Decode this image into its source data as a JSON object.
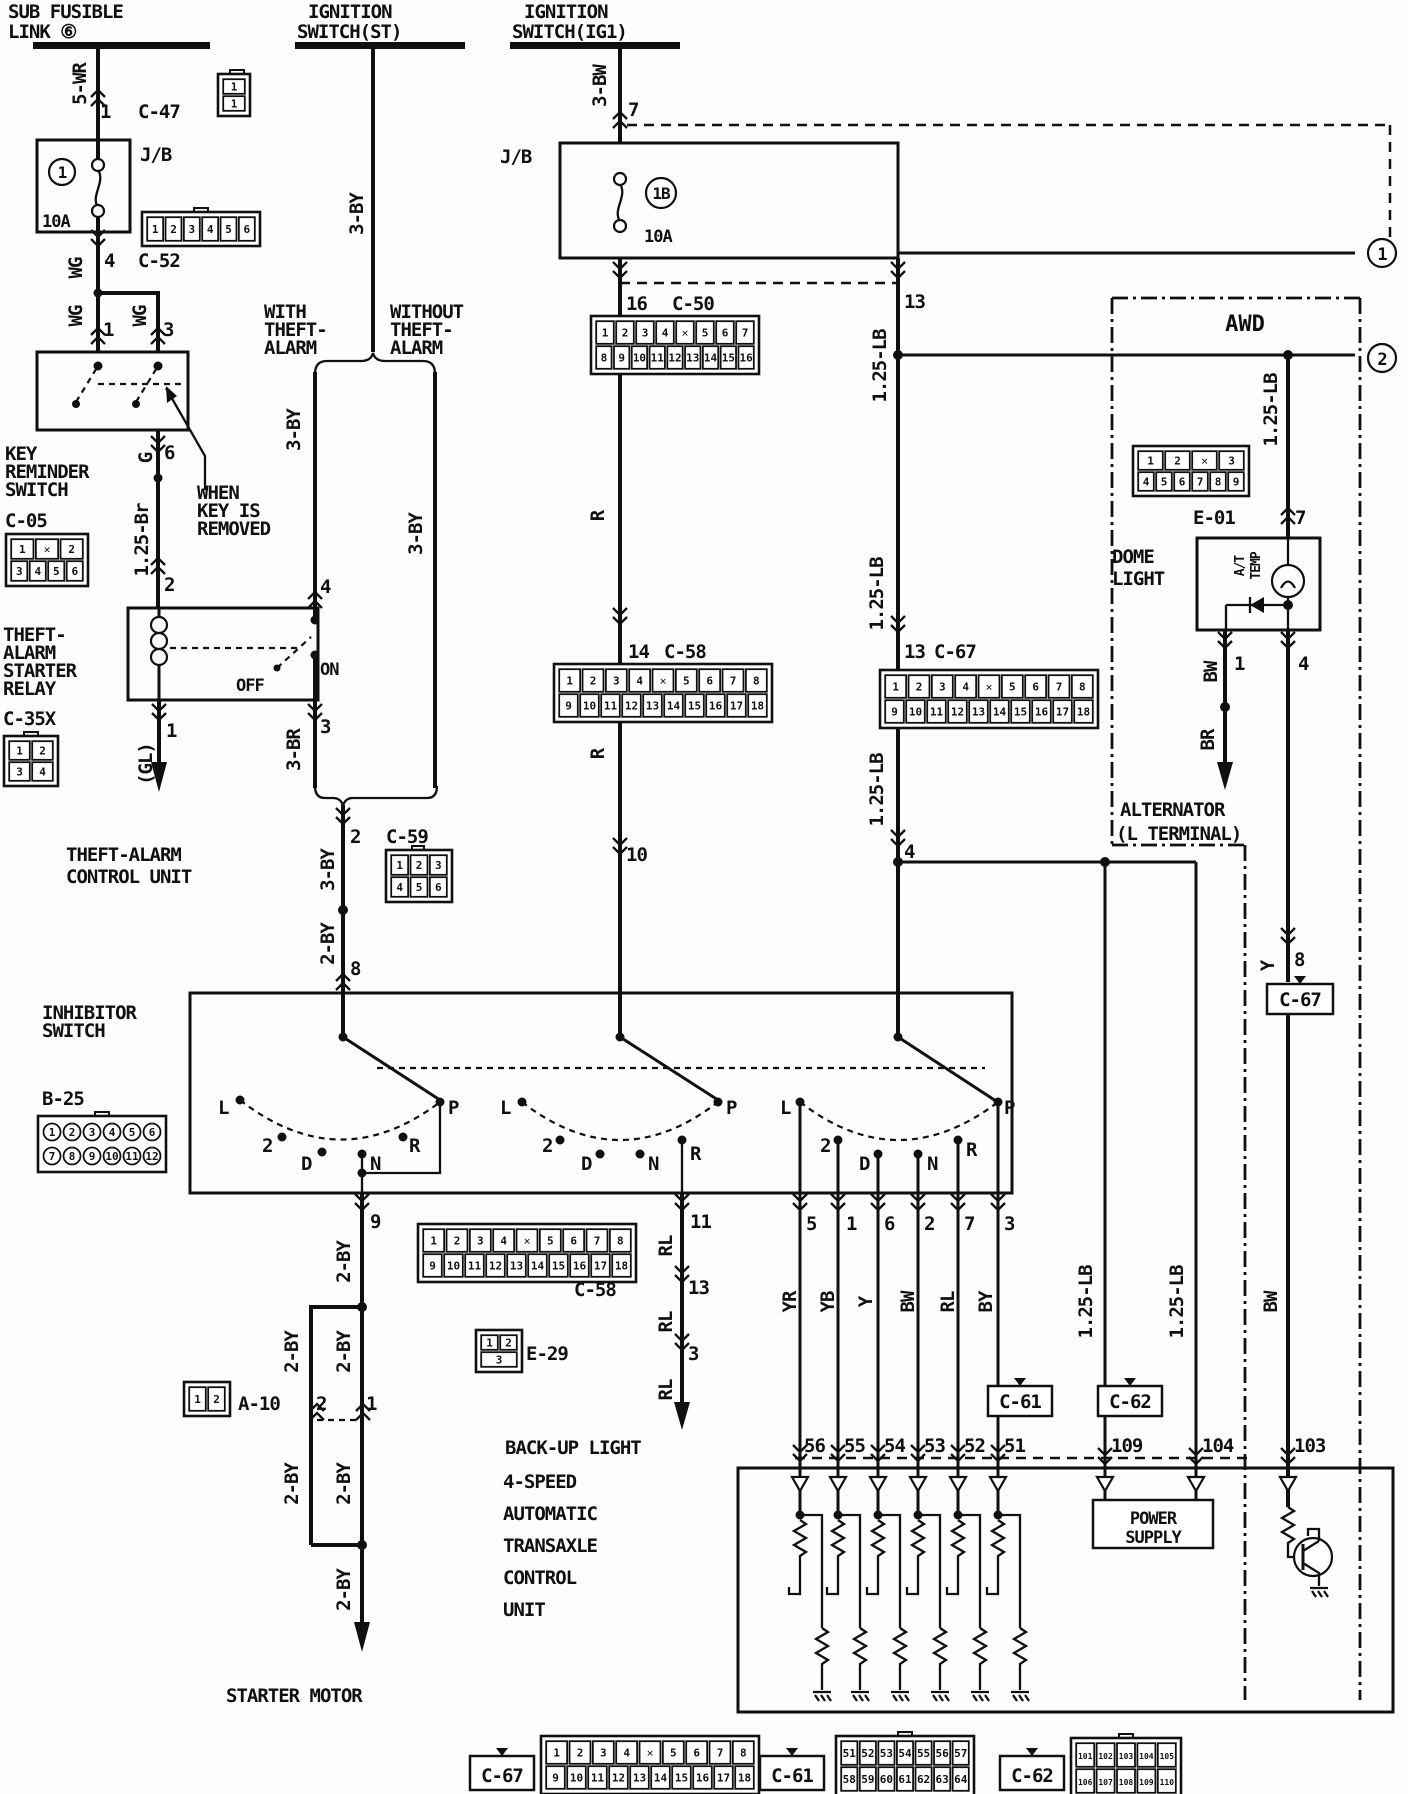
{
  "labels": {
    "sfl1": "SUB FUSIBLE",
    "sfl2": "LINK ⑥",
    "ist1": "IGNITION",
    "ist2": "SWITCH(ST)",
    "iig1": "IGNITION",
    "iig2": "SWITCH(IG1)",
    "w5wr": "5-WR",
    "w3bw": "3-BW",
    "w3by": "3-BY",
    "w3br": "3-BR",
    "w2by": "2-BY",
    "w125br": "1.25-Br",
    "w125lb": "1.25-LB",
    "wgl": "(GL)",
    "wg": "WG",
    "wg_g": "G",
    "wr": "R",
    "wrl": "RL",
    "wbw": "BW",
    "wbr": "BR",
    "wy": "Y",
    "wyr": "YR",
    "wyb": "YB",
    "wby": "BY",
    "p1": "1",
    "p2": "2",
    "p3": "3",
    "p4": "4",
    "p5": "5",
    "p6": "6",
    "p7": "7",
    "p8": "8",
    "p9": "9",
    "p10": "10",
    "p11": "11",
    "p13": "13",
    "p14": "14",
    "p16": "16",
    "p51": "51",
    "p52": "52",
    "p53": "53",
    "p54": "54",
    "p55": "55",
    "p56": "56",
    "p103": "103",
    "p104": "104",
    "p109": "109",
    "c47": "C-47",
    "c52": "C-52",
    "c05": "C-05",
    "c35x": "C-35X",
    "c50": "C-50",
    "c58": "C-58",
    "c59": "C-59",
    "c61": "C-61",
    "c62": "C-62",
    "c67": "C-67",
    "e01": "E-01",
    "e29": "E-29",
    "a10": "A-10",
    "b25": "B-25",
    "jb": "J/B",
    "jb2": "J/B",
    "f1": "1",
    "f1a": "10A",
    "f2": "1B",
    "f2a": "10A",
    "krs1": "KEY",
    "krs2": "REMINDER",
    "krs3": "SWITCH",
    "when1": "WHEN",
    "when2": "KEY IS",
    "when3": "REMOVED",
    "tar1": "THEFT-",
    "tar2": "ALARM",
    "tar3": "STARTER",
    "tar4": "RELAY",
    "off": "OFF",
    "on": "ON",
    "tacu1": "THEFT-ALARM",
    "tacu2": "CONTROL UNIT",
    "with1": "WITH",
    "with2": "THEFT-",
    "with3": "ALARM",
    "wo1": "WITHOUT",
    "wo2": "THEFT-",
    "wo3": "ALARM",
    "inh1": "INHIBITOR",
    "inh2": "SWITCH",
    "posL": "L",
    "pos2": "2",
    "posD": "D",
    "posN": "N",
    "posR": "R",
    "posP": "P",
    "awd": "AWD",
    "dome1": "DOME",
    "dome2": "LIGHT",
    "at1": "A/T",
    "at2": "TEMP",
    "alt1": "ALTERNATOR",
    "alt2": "(L TERMINAL)",
    "backup": "BACK-UP LIGHT",
    "tcu1": "4-SPEED",
    "tcu2": "AUTOMATIC",
    "tcu3": "TRANSAXLE",
    "tcu4": "CONTROL",
    "tcu5": "UNIT",
    "pow1": "POWER",
    "pow2": "SUPPLY",
    "sm": "STARTER MOTOR",
    "m1": "1",
    "m2": "2"
  },
  "grids": {
    "c47": {
      "w": 24,
      "rh": 17,
      "rows": [
        [
          "1"
        ],
        [
          "1"
        ]
      ]
    },
    "c52": {
      "w": 110,
      "rh": 26,
      "rows": [
        [
          "1",
          "2",
          "3",
          "4",
          "5",
          "6"
        ]
      ]
    },
    "c05": {
      "w": 74,
      "rh": 22,
      "rows": [
        [
          "1",
          "✕",
          "2"
        ],
        [
          "3",
          "4",
          "5",
          "6"
        ]
      ]
    },
    "c35x": {
      "w": 46,
      "rh": 21,
      "rows": [
        [
          "1",
          "2"
        ],
        [
          "3",
          "4"
        ]
      ]
    },
    "c50": {
      "w": 160,
      "rh": 25,
      "rows": [
        [
          "1",
          "2",
          "3",
          "4",
          "✕",
          "5",
          "6",
          "7"
        ],
        [
          "8",
          "9",
          "10",
          "11",
          "12",
          "13",
          "14",
          "15",
          "16"
        ]
      ]
    },
    "c58": {
      "w": 210,
      "rh": 25,
      "rows": [
        [
          "1",
          "2",
          "3",
          "4",
          "✕",
          "5",
          "6",
          "7",
          "8"
        ],
        [
          "9",
          "10",
          "11",
          "12",
          "13",
          "14",
          "15",
          "16",
          "17",
          "18"
        ]
      ]
    },
    "c67": {
      "w": 210,
      "rh": 25,
      "rows": [
        [
          "1",
          "2",
          "3",
          "4",
          "✕",
          "5",
          "6",
          "7",
          "8"
        ],
        [
          "9",
          "10",
          "11",
          "12",
          "13",
          "14",
          "15",
          "16",
          "17",
          "18"
        ]
      ]
    },
    "c59": {
      "w": 58,
      "rh": 22,
      "rows": [
        [
          "1",
          "2",
          "3"
        ],
        [
          "4",
          "5",
          "6"
        ]
      ]
    },
    "b25": {
      "w": 120,
      "rh": 24,
      "style": "circle",
      "rows": [
        [
          "1",
          "2",
          "3",
          "4",
          "5",
          "6"
        ],
        [
          "7",
          "8",
          "9",
          "10",
          "11",
          "12"
        ]
      ]
    },
    "e01": {
      "w": 108,
      "rh": 21,
      "rows": [
        [
          "1",
          "2",
          "✕",
          "3"
        ],
        [
          "4",
          "5",
          "6",
          "7",
          "8",
          "9"
        ]
      ]
    },
    "e29": {
      "w": 38,
      "rh": 17,
      "rows": [
        [
          "1",
          "2"
        ],
        [
          "3"
        ]
      ]
    },
    "a10": {
      "w": 38,
      "rh": 26,
      "rows": [
        [
          "1",
          "2"
        ]
      ]
    },
    "c61": {
      "w": 130,
      "rh": 26,
      "rows": [
        [
          "51",
          "52",
          "53",
          "54",
          "55",
          "56",
          "57"
        ],
        [
          "58",
          "59",
          "60",
          "61",
          "62",
          "63",
          "64"
        ]
      ]
    },
    "c62": {
      "w": 102,
      "rh": 26,
      "rows": [
        [
          "101",
          "102",
          "103",
          "104",
          "105"
        ],
        [
          "106",
          "107",
          "108",
          "109",
          "110"
        ]
      ]
    }
  }
}
